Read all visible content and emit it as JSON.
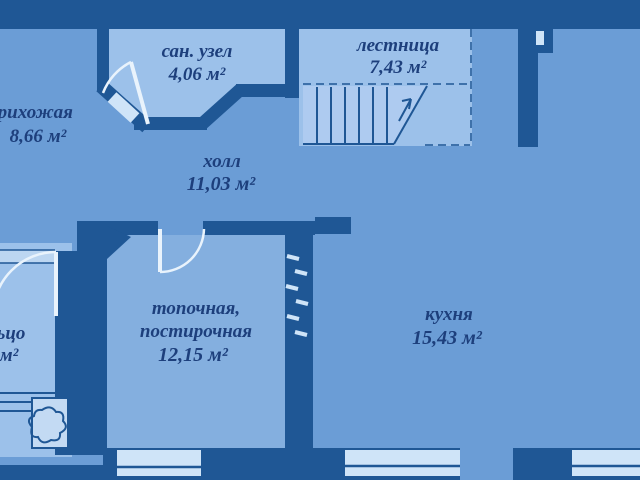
{
  "plan": {
    "type": "floor-plan",
    "rooms": {
      "sanuzel": {
        "name": "сан. узел",
        "area": "4,06 м²"
      },
      "lestnitsa": {
        "name": "лестница",
        "area": "7,43 м²"
      },
      "prihozhaya": {
        "name": "прихожая",
        "area": "8,66 м²"
      },
      "holl": {
        "name": "холл",
        "area": "11,03 м²"
      },
      "topochnaya": {
        "name_line1": "топочная,",
        "name_line2": "постирочная",
        "area": "12,15 м²"
      },
      "kuhnya": {
        "name": "кухня",
        "area": "15,43 м²"
      },
      "kryltso": {
        "name": "крыльцо",
        "area_partial": "м²"
      }
    },
    "colors": {
      "wall": "#1f5795",
      "floor": "#6b9dd6",
      "room_light": "#9cc1ea",
      "room_light2": "#84afdf",
      "steps": "#aecbf0",
      "window": "#cfe4f8",
      "door": "#e9f3fc",
      "text": "#1d3f7c"
    }
  }
}
